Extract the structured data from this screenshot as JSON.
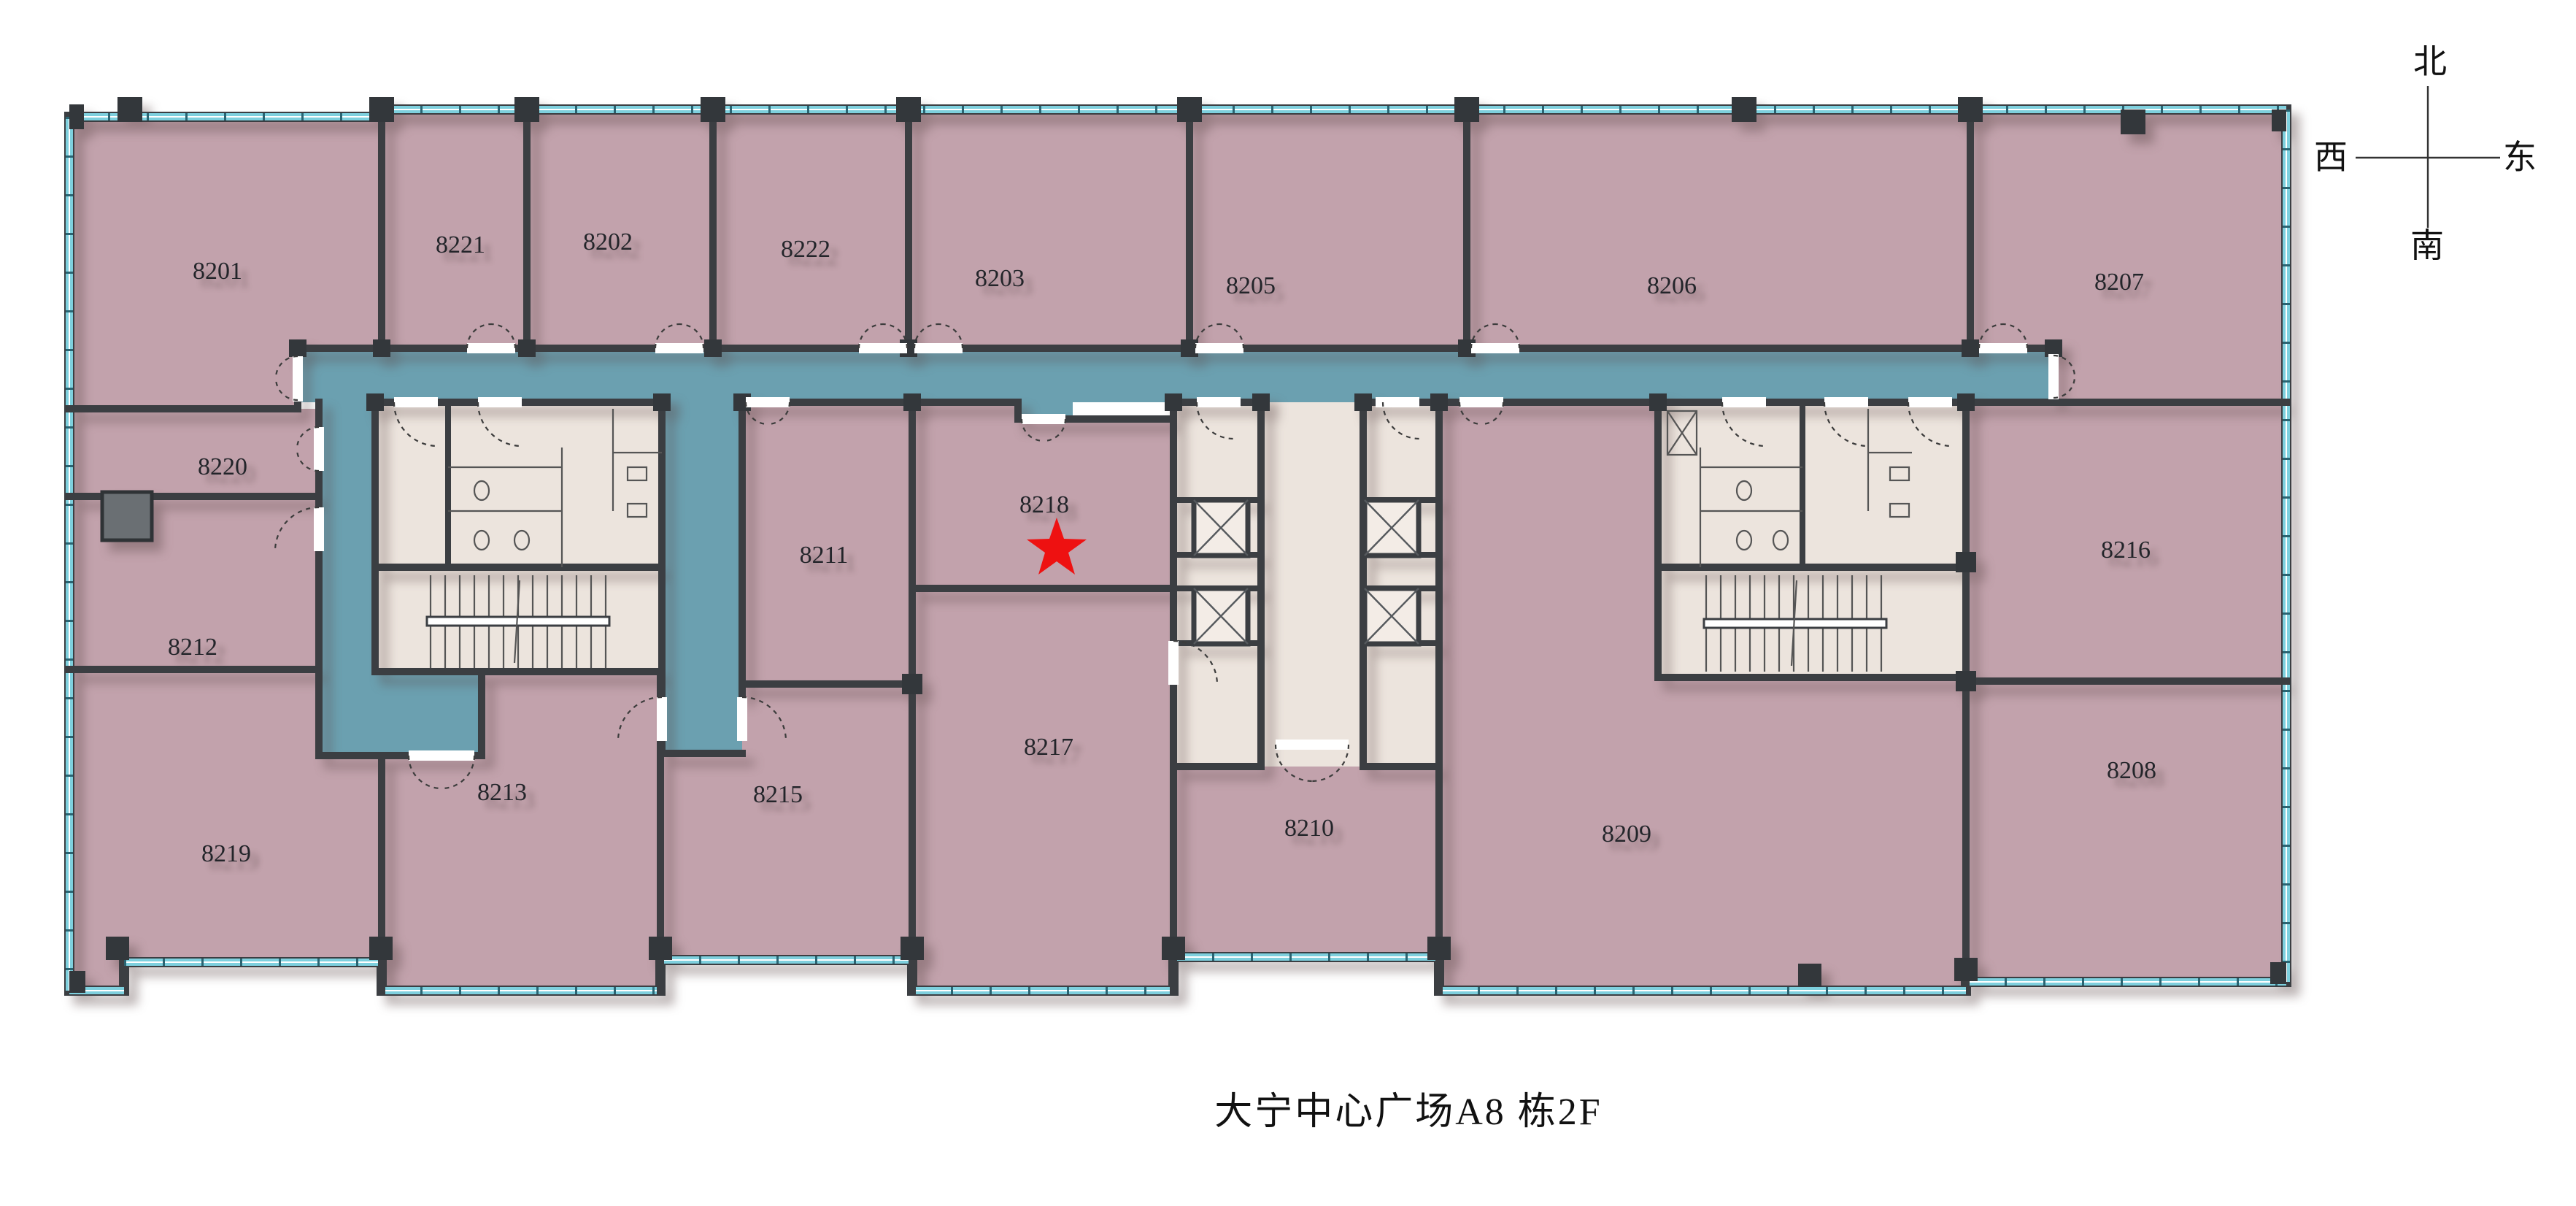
{
  "title": "大宁中心广场A8 栋2F",
  "compass": {
    "north": "北",
    "south": "南",
    "east": "东",
    "west": "西"
  },
  "rooms": {
    "r8201": "8201",
    "r8202": "8202",
    "r8203": "8203",
    "r8205": "8205",
    "r8206": "8206",
    "r8207": "8207",
    "r8208": "8208",
    "r8209": "8209",
    "r8210": "8210",
    "r8211": "8211",
    "r8212": "8212",
    "r8213": "8213",
    "r8215": "8215",
    "r8216": "8216",
    "r8217": "8217",
    "r8218": "8218",
    "r8219": "8219",
    "r8220": "8220",
    "r8221": "8221",
    "r8222": "8222"
  },
  "highlight": {
    "room": "8218",
    "marker": "red-star"
  },
  "colors": {
    "room_fill": "#c2a2ac",
    "corridor_fill": "#6ba0b0",
    "core_fill": "#ece4dd",
    "wall": "#3b3e42",
    "glazing": "#7ed0de",
    "star": "#ee1111"
  }
}
